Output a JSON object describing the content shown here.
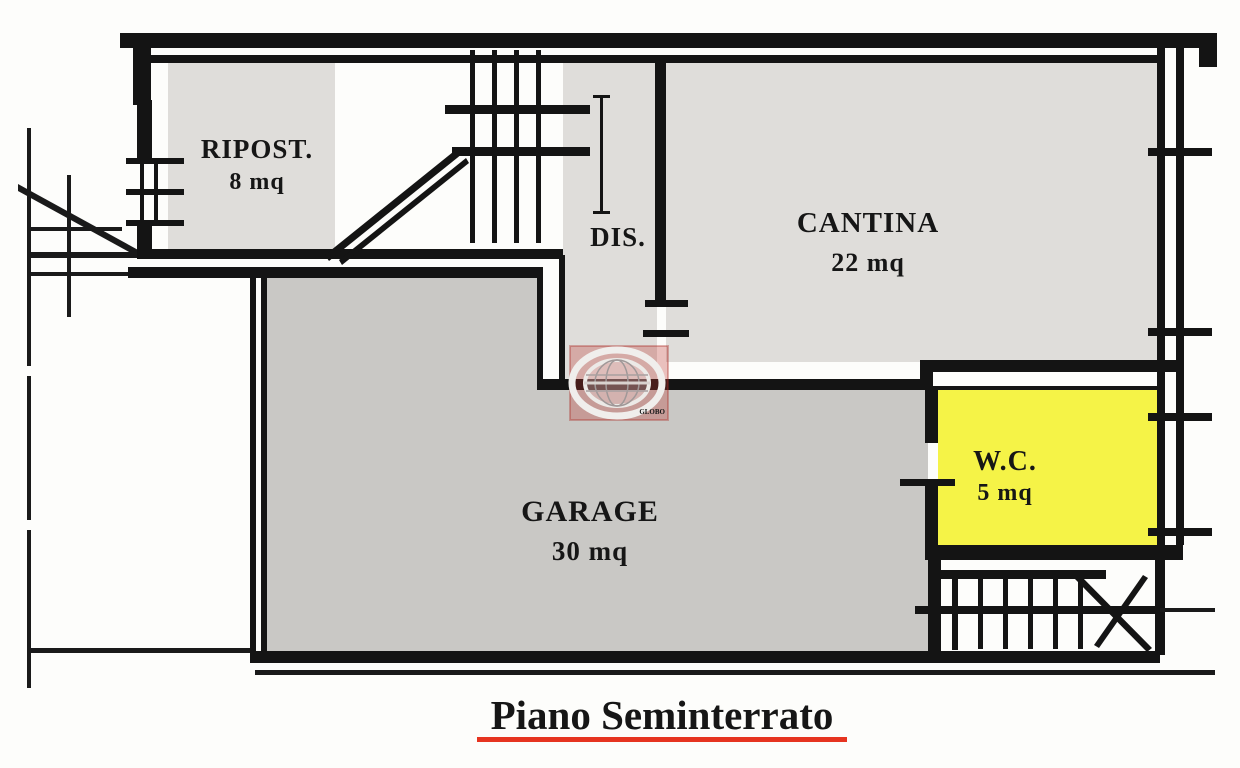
{
  "title": {
    "text": "Piano Seminterrato"
  },
  "rooms": {
    "ripost": {
      "label": "RIPOST.",
      "area": "8 mq"
    },
    "dis": {
      "label": "DIS."
    },
    "cantina": {
      "label": "CANTINA",
      "area": "22 mq"
    },
    "garage": {
      "label": "GARAGE",
      "area": "30 mq"
    },
    "wc": {
      "label": "W.C.",
      "area": "5 mq"
    }
  },
  "watermark": {
    "caption": "GLOBO"
  },
  "colors": {
    "paper": "#fdfdfb",
    "wall": "#141414",
    "thin_line": "#1a1a1a",
    "room_fill": "#dfddda",
    "garage_fill": "#c9c8c5",
    "wc_fill": "#f5f347",
    "title_red": "#e63420",
    "watermark_red": "rgba(193,52,45,0.30)"
  }
}
